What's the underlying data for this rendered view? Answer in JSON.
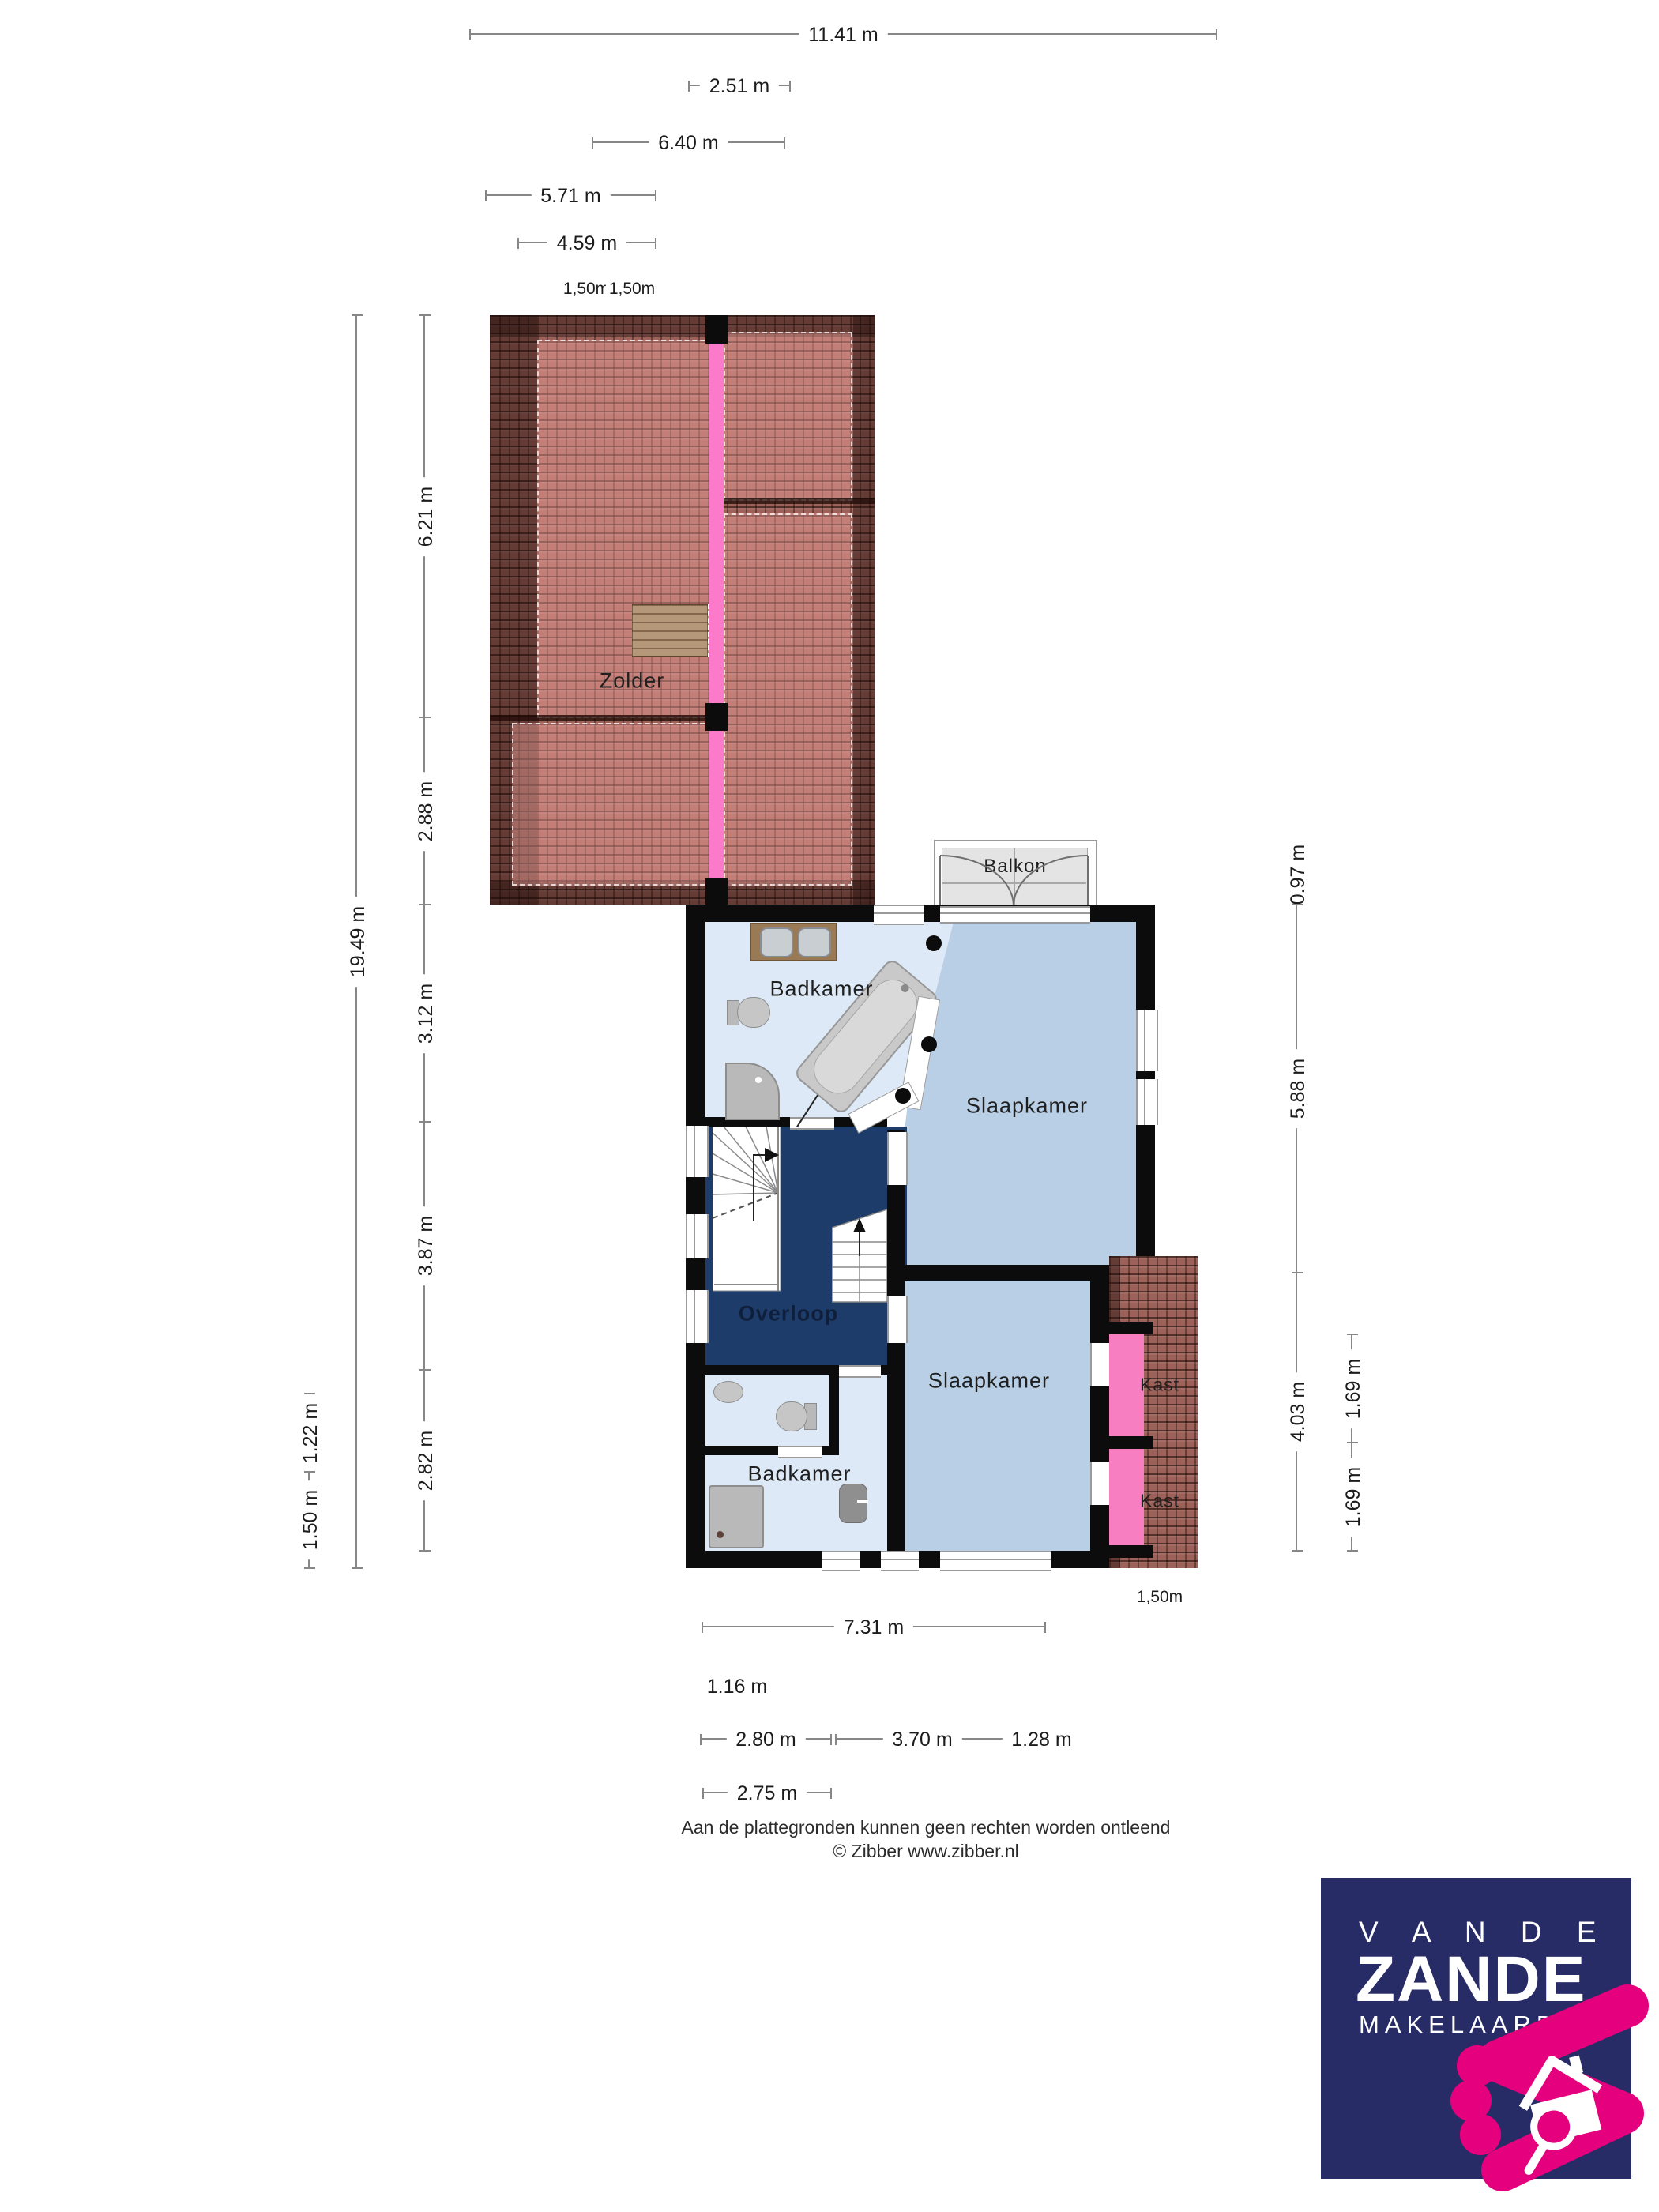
{
  "rooms": {
    "zolder": "Zolder",
    "badkamer1": "Badkamer",
    "slaapkamer1": "Slaapkamer",
    "overloop": "Overloop",
    "badkamer2": "Badkamer",
    "slaapkamer2": "Slaapkamer",
    "kast1": "Kast",
    "kast2": "Kast",
    "balkon": "Balkon"
  },
  "dims": {
    "d1141": "11.41 m",
    "d251": "2.51 m",
    "d640": "6.40 m",
    "d571": "5.71 m",
    "d459": "4.59 m",
    "ridge150a": "1,50m",
    "ridge150b": "1,50m",
    "d1949": "19.49 m",
    "d621": "6.21 m",
    "d288": "2.88 m",
    "d312": "3.12 m",
    "d387": "3.87 m",
    "d282": "2.82 m",
    "d122": "1.22 m",
    "d150": "1.50 m",
    "d097": "0.97 m",
    "d588": "5.88 m",
    "d403": "4.03 m",
    "d169a": "1.69 m",
    "d169b": "1.69 m",
    "d731": "7.31 m",
    "d116": "1.16 m",
    "d280": "2.80 m",
    "d370": "3.70 m",
    "d128": "1.28 m",
    "d275": "2.75 m",
    "dormer150": "1,50m"
  },
  "footer": {
    "line1": "Aan de plattegronden kunnen geen rechten worden ontleend",
    "line2": "© Zibber www.zibber.nl"
  },
  "logo": {
    "line1": "V A N D E",
    "line2": "ZANDE",
    "line3": "MAKELAARDIJ"
  },
  "colors": {
    "roof_tile": "#9c6158",
    "ridge_pink": "#fb7bca",
    "kast_pink": "#f87ec2",
    "hall_navy": "#1d3c6a",
    "bedroom_blue": "#b9cfe6",
    "bath_blue": "#dde9f6",
    "wall_black": "#0c0c0c",
    "logo_navy": "#272b66",
    "logo_pink": "#e5007d"
  }
}
